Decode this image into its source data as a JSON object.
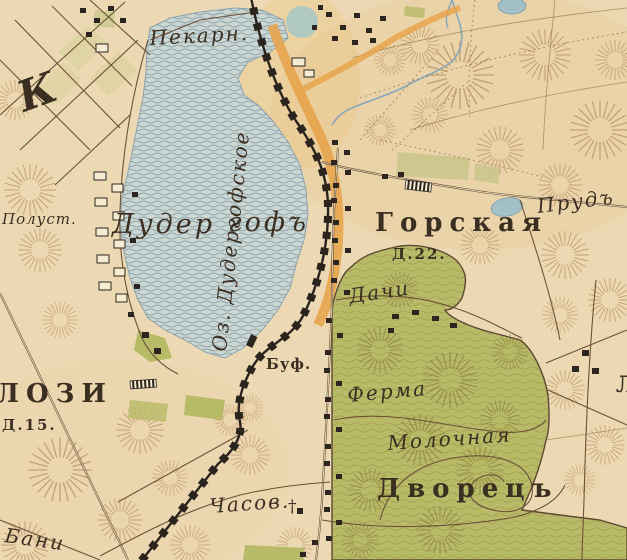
{
  "map": {
    "kind": "historical-topographic-map",
    "labels": {
      "bakery": "Пекарн.",
      "lake": "Оз. Дудергофское",
      "halt_prefix": "Полуст.",
      "duderhof_left": "Дудер",
      "duderhof_right": "гофъ",
      "gorskaya": "Горская",
      "gorskaya_houses": "Д.22.",
      "dachas": "Дачи",
      "pond": "Прудъ",
      "buffet": "Буф.",
      "villozi": "ЛОЗИ",
      "villozi_houses": "Д.15.",
      "farm_line1": "Ферма",
      "farm_line2": "Молочная",
      "palace": "Дворецъ",
      "chapel": "Часов.",
      "chapel_cross": "†",
      "baths": "Бани",
      "letter_k": "К",
      "edge_letter": "Л"
    },
    "colors": {
      "paper": "#ecd9b3",
      "lake_fill": "#cdd7d2",
      "lake_wave": "#7d97a6",
      "park_green": "#b7ba67",
      "field_green": "#c9c68c",
      "road_orange": "#e7a44c",
      "railway_black": "#2a241d",
      "hachure_brown": "#a06a38",
      "road_brown": "#5d4631",
      "stream_blue": "#7ea3bc",
      "ink": "#3a2f21"
    }
  }
}
